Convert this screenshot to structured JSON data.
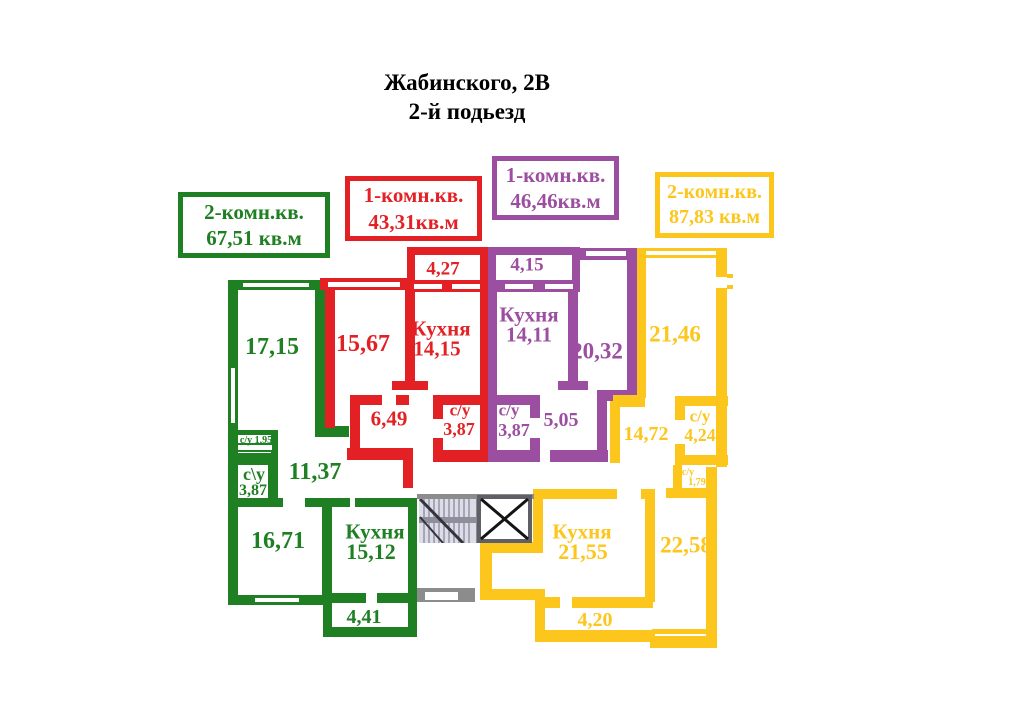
{
  "title": {
    "line1": "Жабинского, 2В",
    "line2": "2-й подьезд"
  },
  "colors": {
    "green": "#1e8022",
    "red": "#e32125",
    "purple": "#9c4fa0",
    "yellow": "#fcc61c",
    "gray": "#8c8c8c"
  },
  "legend": {
    "green": {
      "line1": "2-комн.кв.",
      "line2": "67,51 кв.м"
    },
    "red": {
      "line1": "1-комн.кв.",
      "line2": "43,31кв.м"
    },
    "purple": {
      "line1": "1-комн.кв.",
      "line2": "46,46кв.м"
    },
    "yellow": {
      "line1": "2-комн.кв.",
      "line2": "87,83 кв.м"
    }
  },
  "rooms": {
    "g_17_15": "17,15",
    "g_su195": "с/у 1,95",
    "g_su387_name": "с\\у",
    "g_su387_val": "3,87",
    "g_11_37": "11,37",
    "g_16_71": "16,71",
    "g_kitchen_name": "Кухня",
    "g_kitchen_val": "15,12",
    "g_balcony": "4,41",
    "r_15_67": "15,67",
    "r_kitchen_name": "Кухня",
    "r_kitchen_val": "14,15",
    "r_balcony": "4,27",
    "r_6_49": "6,49",
    "r_su_name": "с/у",
    "r_su_val": "3,87",
    "p_balcony": "4,15",
    "p_kitchen_name": "Кухня",
    "p_kitchen_val": "14,11",
    "p_20_32": "20,32",
    "p_su_name": "с/у",
    "p_su_val": "3,87",
    "p_5_05": "5,05",
    "y_21_46": "21,46",
    "y_14_72": "14,72",
    "y_su1_name": "с/у",
    "y_su1_val": "4,24",
    "y_su2_name": "с/у",
    "y_su2_val": "1,79",
    "y_22_58": "22,58",
    "y_kitchen_name": "Кухня",
    "y_kitchen_val": "21,55",
    "y_balcony": "4,20"
  }
}
